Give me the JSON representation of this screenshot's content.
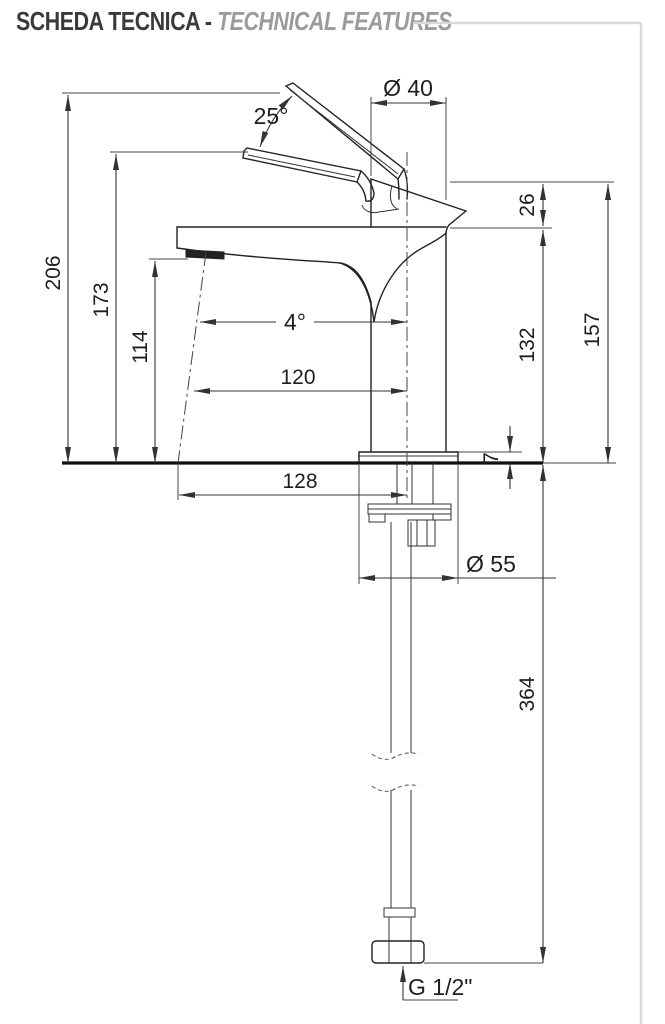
{
  "header": {
    "title_it": "SCHEDA TECNICA - ",
    "title_en": "TECHNICAL FEATURES"
  },
  "drawing": {
    "dimensions": {
      "handle_open_angle": "25°",
      "body_diameter": "Ø 40",
      "spout_to_top": "26",
      "height_total": "206",
      "height_handle_open": "173",
      "height_aerator": "114",
      "height_spout": "132",
      "height_body": "157",
      "stream_angle": "4°",
      "reach_spout": "120",
      "reach_base": "128",
      "base_plate_thickness": "7",
      "base_diameter": "Ø 55",
      "hose_length": "364",
      "thread": "G 1/2\""
    }
  }
}
